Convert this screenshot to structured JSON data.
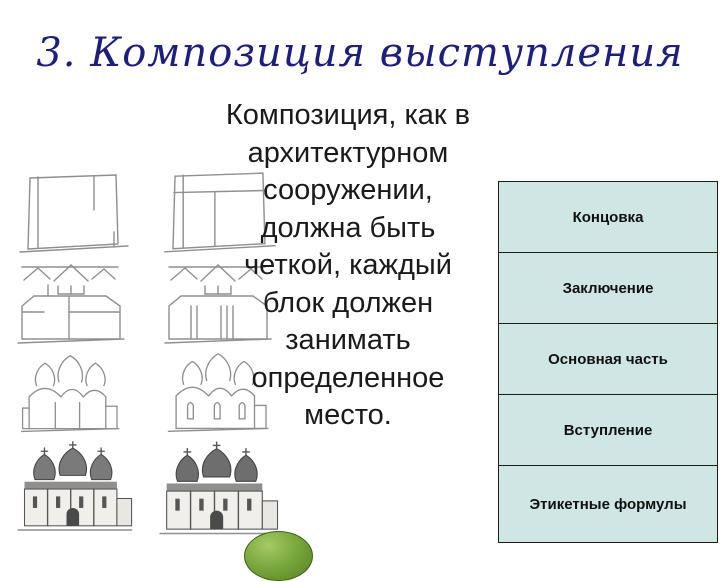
{
  "slide": {
    "title": "3. Композиция выступления",
    "body_lines": [
      "Композиция, как в",
      "архитектурном",
      "сооружении,",
      "должна быть",
      "четкой, каждый",
      "блок должен",
      "занимать",
      "определенное",
      "место."
    ]
  },
  "structure_diagram": {
    "blocks": [
      {
        "label": "Концовка"
      },
      {
        "label": "Заключение"
      },
      {
        "label": "Основная часть"
      },
      {
        "label": "Вступление"
      },
      {
        "label": "Этикетные формулы"
      }
    ]
  },
  "illustration": {
    "stages": [
      "building-outline-sketch",
      "building-roofline-sketch",
      "building-domes-outline-sketch",
      "finished-church-sketch"
    ],
    "decor": "green-ellipse"
  },
  "colors": {
    "background": "#ffffff",
    "title": "#1e1e7d",
    "body_text": "#1a1a1a",
    "block_fill": "#cfe6e5",
    "block_border": "#1c1c1c",
    "ellipse_green": "#6f9d3c"
  }
}
